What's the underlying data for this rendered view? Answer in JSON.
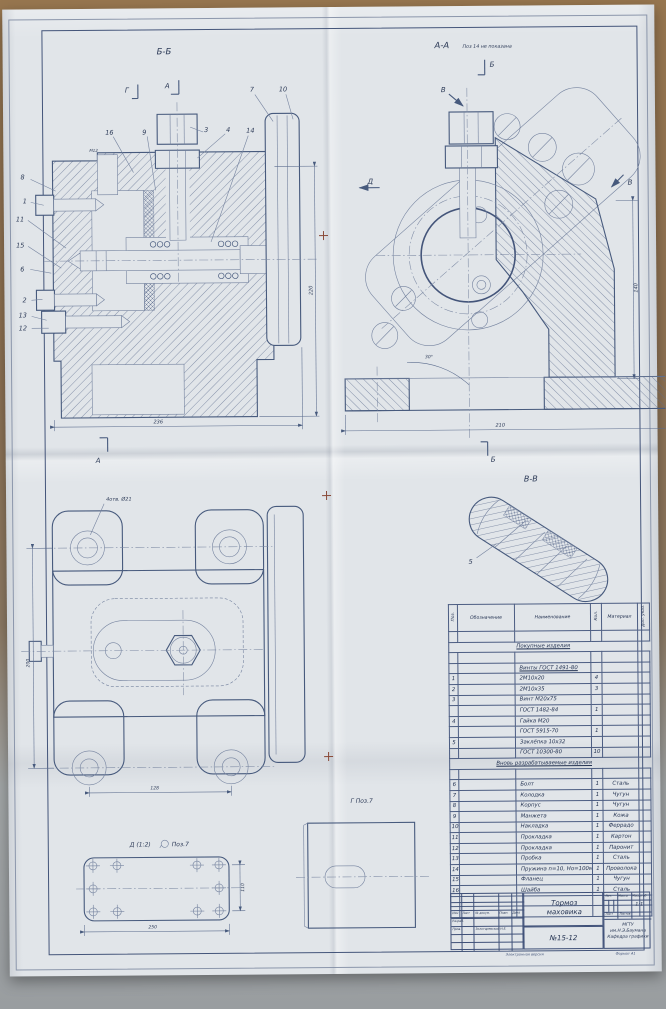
{
  "views": {
    "bb": {
      "title": "Б-Б",
      "mark_g": "Г",
      "mark_a": "А",
      "mark_a_bottom": "А",
      "thread": "М12",
      "dim_width": "236",
      "dim_height": "220",
      "callouts": {
        "c16": "16",
        "c9": "9",
        "c3": "3",
        "c4": "4",
        "c14": "14",
        "c7": "7",
        "c10": "10",
        "c8": "8",
        "c1": "1",
        "c11": "11",
        "c15": "15",
        "c6": "6",
        "c2": "2",
        "c13": "13",
        "c12": "12"
      }
    },
    "aa": {
      "title": "А-А",
      "note": "Поз 14 не показана",
      "mark_b_top": "Б",
      "mark_b_bottom": "Б",
      "mark_v_left": "В",
      "mark_v_right": "В",
      "mark_d": "Д",
      "dim_width": "210",
      "dim_height": "140",
      "angle": "30°"
    },
    "vv": {
      "title": "В-В",
      "callout_5": "5"
    },
    "flange": {
      "hole_note": "4отв. Ø21",
      "dim_height": "200",
      "dim_width": "128"
    },
    "d_view": {
      "title": "Д (1:2)",
      "pos_note": "Поз.7",
      "dim_width": "250",
      "dim_height": "110"
    },
    "g_view": {
      "title": "Г Поз.7"
    }
  },
  "spec": {
    "headers": {
      "pos": "Поз.",
      "designation": "Обозначение",
      "name": "Наименование",
      "qty": "Кол.",
      "material": "Материал",
      "note": "Доп. указ."
    },
    "rows": [
      {
        "pos": "",
        "designation": "",
        "name": "",
        "qty": "",
        "material": ""
      },
      {
        "section": "Покупные изделия"
      },
      {
        "pos": "",
        "designation": "",
        "name": "",
        "qty": "",
        "material": ""
      },
      {
        "pos": "",
        "designation": "",
        "name": "Винты ГОСТ 1491-80",
        "qty": "",
        "material": "",
        "u": true
      },
      {
        "pos": "1",
        "designation": "",
        "name": "2М10х20",
        "qty": "4",
        "material": ""
      },
      {
        "pos": "2",
        "designation": "",
        "name": "2М10х35",
        "qty": "3",
        "material": ""
      },
      {
        "pos": "3",
        "designation": "",
        "name": "Винт М20х75",
        "qty": "",
        "material": ""
      },
      {
        "pos": "",
        "designation": "",
        "name": "ГОСТ 1482-84",
        "qty": "1",
        "material": ""
      },
      {
        "pos": "4",
        "designation": "",
        "name": "Гайка М20",
        "qty": "",
        "material": ""
      },
      {
        "pos": "",
        "designation": "",
        "name": "ГОСТ 5915-70",
        "qty": "1",
        "material": ""
      },
      {
        "pos": "5",
        "designation": "",
        "name": "Заклёпка 10х32",
        "qty": "",
        "material": ""
      },
      {
        "pos": "",
        "designation": "",
        "name": "ГОСТ 10300-80",
        "qty": "10",
        "material": ""
      },
      {
        "section": "Вновь разрабатываемые изделия"
      },
      {
        "pos": "",
        "designation": "",
        "name": "",
        "qty": "",
        "material": ""
      },
      {
        "pos": "6",
        "designation": "",
        "name": "Болт",
        "qty": "1",
        "material": "Сталь"
      },
      {
        "pos": "7",
        "designation": "",
        "name": "Колодка",
        "qty": "1",
        "material": "Чугун"
      },
      {
        "pos": "8",
        "designation": "",
        "name": "Корпус",
        "qty": "1",
        "material": "Чугун"
      },
      {
        "pos": "9",
        "designation": "",
        "name": "Манжета",
        "qty": "1",
        "material": "Кожа"
      },
      {
        "pos": "10",
        "designation": "",
        "name": "Накладка",
        "qty": "1",
        "material": "Феррадо"
      },
      {
        "pos": "11",
        "designation": "",
        "name": "Прокладка",
        "qty": "1",
        "material": "Картон"
      },
      {
        "pos": "12",
        "designation": "",
        "name": "Прокладка",
        "qty": "1",
        "material": "Паронит"
      },
      {
        "pos": "13",
        "designation": "",
        "name": "Пробка",
        "qty": "1",
        "material": "Сталь"
      },
      {
        "pos": "14",
        "designation": "",
        "name": "Пружина n=10, Но=100мм",
        "qty": "1",
        "material": "Проволока"
      },
      {
        "pos": "15",
        "designation": "",
        "name": "Фланец",
        "qty": "1",
        "material": "Чугун"
      },
      {
        "pos": "16",
        "designation": "",
        "name": "Шайба",
        "qty": "1",
        "material": "Сталь"
      },
      {
        "pos": "",
        "designation": "",
        "name": "",
        "qty": "",
        "material": ""
      },
      {
        "pos": "",
        "designation": "",
        "name": "",
        "qty": "",
        "material": ""
      }
    ]
  },
  "title_block": {
    "labels": {
      "izm": "Изм",
      "list": "Лист",
      "doc": "№ докум.",
      "podp": "Подп.",
      "data": "Дата",
      "razrab": "Разраб.",
      "prov": "Пров.",
      "lit": "Лит.",
      "massa": "Масса",
      "masshtab": "Масштаб",
      "list2": "Лист",
      "listov": "Листов"
    },
    "checker": "Золотаревский Н.Е.",
    "title_line1": "Тормоз",
    "title_line2": "маховика",
    "doc_no": "№15-12",
    "scale": "1:1",
    "org_line1": "МГТУ им.Н.Э.Баумана",
    "org_line2": "Кафедра графики",
    "footer_center": "Электронная версия",
    "footer_right": "Формат А1"
  }
}
